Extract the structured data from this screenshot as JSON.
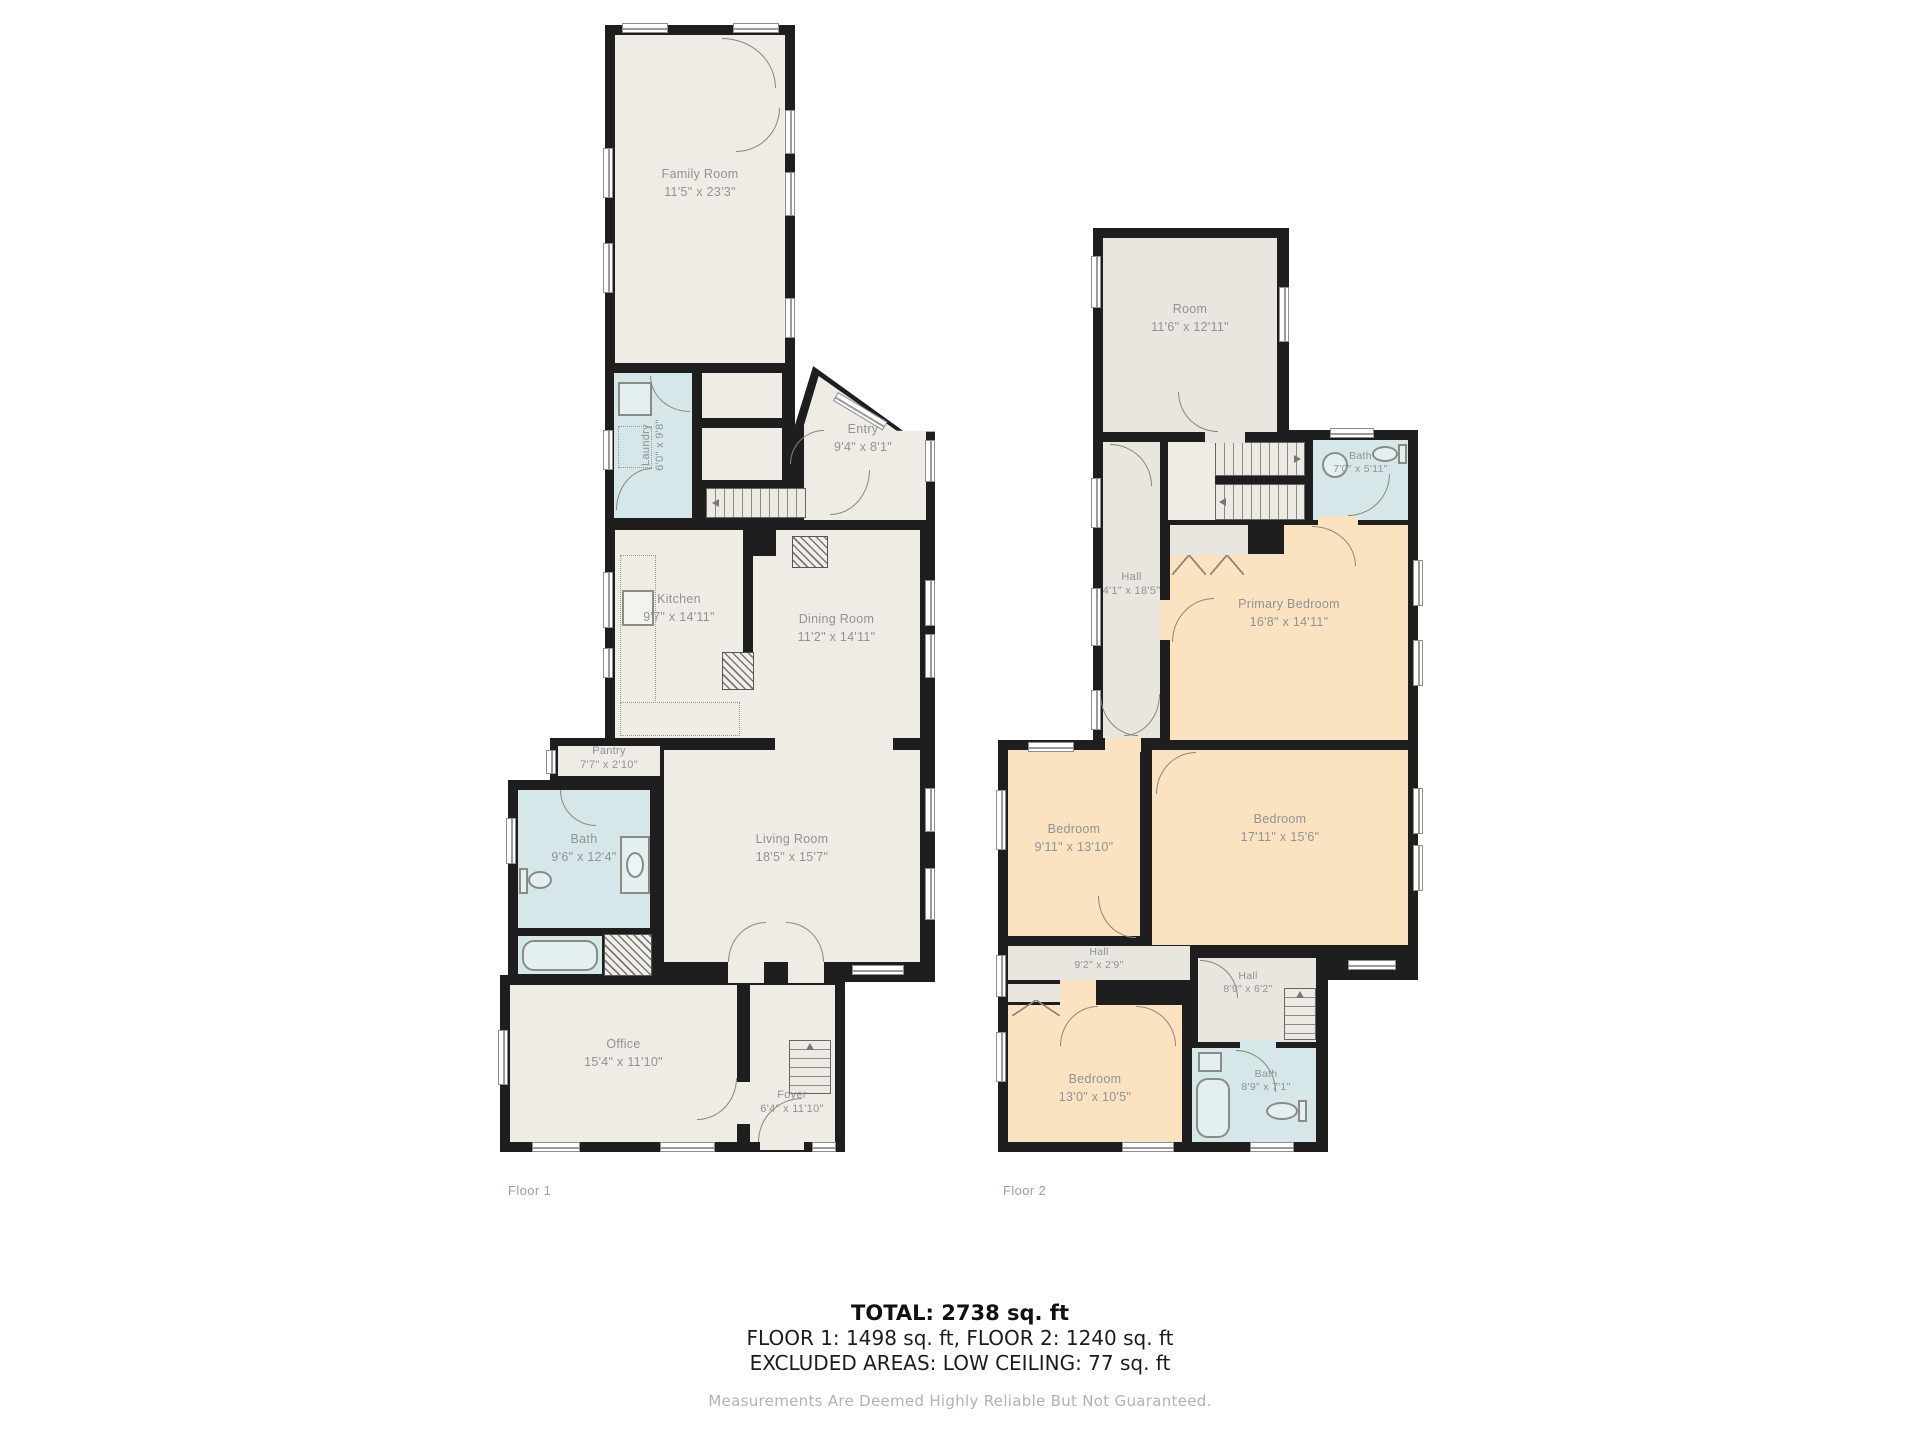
{
  "colors": {
    "wall": "#1e1e1e",
    "room_fill": "#efece6",
    "wet_fill": "#d5e7e8",
    "bedroom_fill": "#fbe3c2",
    "hall_fill": "#e9e6e0",
    "label_text": "#8f9394"
  },
  "floor1": {
    "caption": "Floor 1",
    "family_room": {
      "name": "Family Room",
      "dims": "11'5\" x 23'3\""
    },
    "laundry": {
      "name": "Laundry",
      "dims": "6'0\" x 9'8\""
    },
    "entry": {
      "name": "Entry",
      "dims": "9'4\" x 8'1\""
    },
    "kitchen": {
      "name": "Kitchen",
      "dims": "9'7\" x 14'11\""
    },
    "dining_room": {
      "name": "Dining Room",
      "dims": "11'2\" x 14'11\""
    },
    "pantry": {
      "name": "Pantry",
      "dims": "7'7\" x 2'10\""
    },
    "bath": {
      "name": "Bath",
      "dims": "9'6\" x 12'4\""
    },
    "living_room": {
      "name": "Living Room",
      "dims": "18'5\" x 15'7\""
    },
    "office": {
      "name": "Office",
      "dims": "15'4\" x 11'10\""
    },
    "foyer": {
      "name": "Foyer",
      "dims": "6'4\" x 11'10\""
    }
  },
  "floor2": {
    "caption": "Floor 2",
    "room": {
      "name": "Room",
      "dims": "11'6\" x 12'11\""
    },
    "bath_top": {
      "name": "Bath",
      "dims": "7'0\" x 5'11\""
    },
    "hall": {
      "name": "Hall",
      "dims": "4'1\" x 18'5\""
    },
    "primary_bedroom": {
      "name": "Primary Bedroom",
      "dims": "16'8\" x 14'11\""
    },
    "bedroom_left": {
      "name": "Bedroom",
      "dims": "9'11\" x 13'10\""
    },
    "bedroom_right": {
      "name": "Bedroom",
      "dims": "17'11\" x 15'6\""
    },
    "hall_small": {
      "name": "Hall",
      "dims": "9'2\" x 2'9\""
    },
    "hall_bottom": {
      "name": "Hall",
      "dims": "8'9\" x 6'2\""
    },
    "bedroom_bottom": {
      "name": "Bedroom",
      "dims": "13'0\" x 10'5\""
    },
    "bath_bottom": {
      "name": "Bath",
      "dims": "8'9\" x 7'1\""
    }
  },
  "summary": {
    "total": "TOTAL: 2738 sq. ft",
    "floors": "FLOOR 1: 1498 sq. ft, FLOOR 2: 1240 sq. ft",
    "excluded": "EXCLUDED AREAS: LOW CEILING: 77 sq. ft",
    "disclaimer": "Measurements Are Deemed Highly Reliable But Not Guaranteed."
  }
}
